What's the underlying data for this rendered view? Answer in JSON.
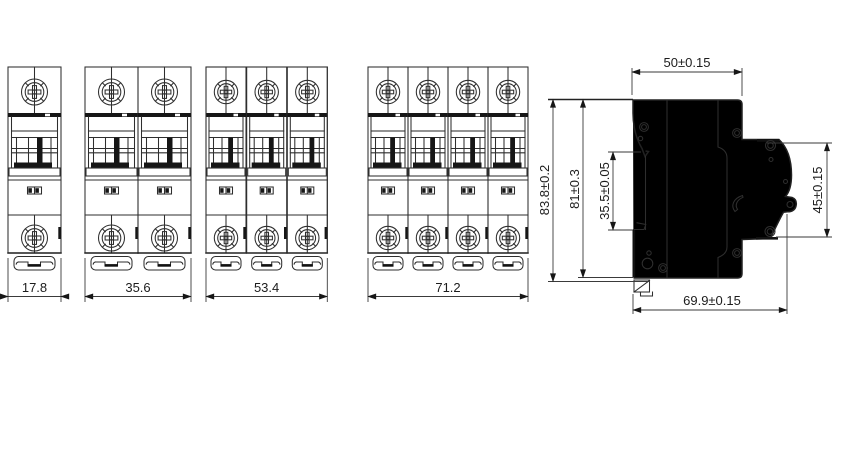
{
  "drawing": {
    "type": "technical-dimension-drawing",
    "subject": "miniature circuit breaker outline drawings",
    "front_views": [
      {
        "poles": 1,
        "width_label": "17.8"
      },
      {
        "poles": 2,
        "width_label": "35.6"
      },
      {
        "poles": 3,
        "width_label": "53.4"
      },
      {
        "poles": 4,
        "width_label": "71.2"
      }
    ],
    "side_view": {
      "top_width_label": "50±0.15",
      "overall_height_label": "83.8±0.2",
      "body_height_label": "81±0.3",
      "din_slot_height_label": "35.5±0.05",
      "front_face_height_label": "45±0.15",
      "overall_depth_label": "69.9±0.15"
    },
    "colors": {
      "line": "#2e2e2e",
      "background": "#ffffff"
    }
  }
}
